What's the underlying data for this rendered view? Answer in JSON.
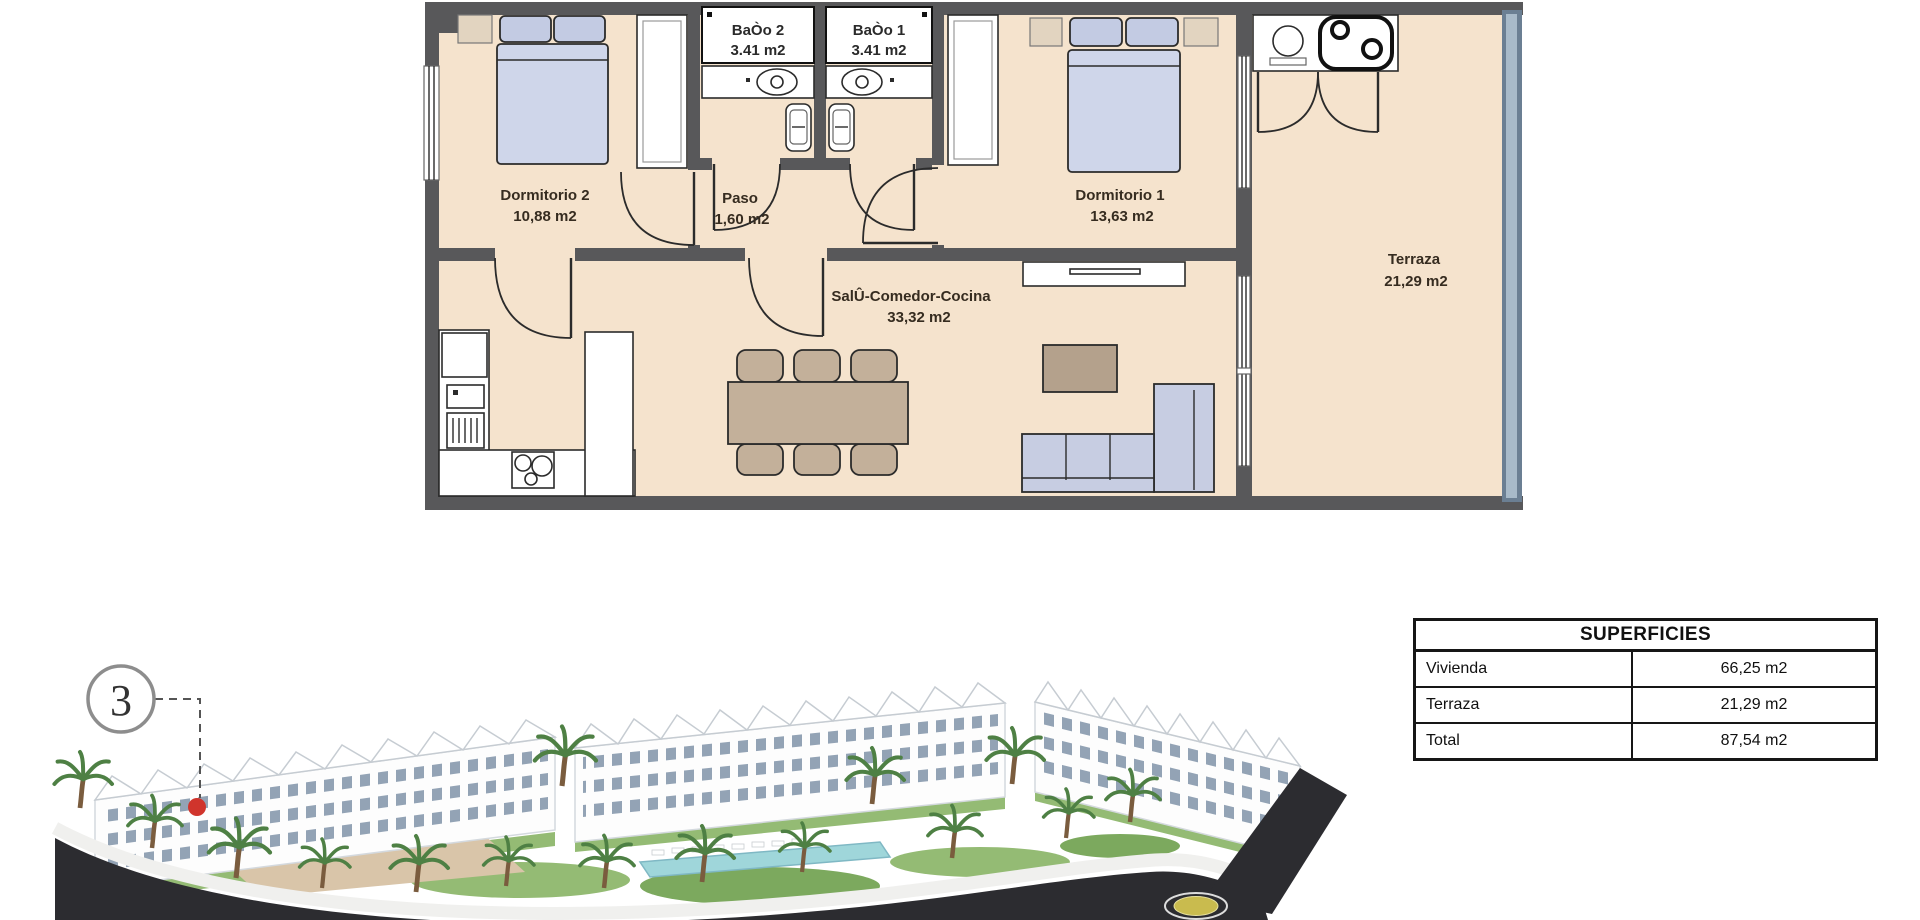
{
  "floor_plan": {
    "rooms": {
      "bano2": {
        "name": "BaÒo 2",
        "area": "3.41 m2"
      },
      "bano1": {
        "name": "BaÒo 1",
        "area": "3.41 m2"
      },
      "dormitorio2": {
        "name": "Dormitorio 2",
        "area": "10,88 m2"
      },
      "paso": {
        "name": "Paso",
        "area": "1,60 m2"
      },
      "dormitorio1": {
        "name": "Dormitorio 1",
        "area": "13,63 m2"
      },
      "salon": {
        "name": "SalÛ-Comedor-Cocina",
        "area": "33,32 m2"
      },
      "terraza": {
        "name": "Terraza",
        "area": "21,29 m2"
      }
    },
    "palette": {
      "wall": "#58585a",
      "floor": "#f5e3cd",
      "bed": "#cfd6ea",
      "sofa": "#c7cde2",
      "wood": "#c3b09a",
      "balustrade": "#8ba0b5"
    }
  },
  "superficies_table": {
    "title": "SUPERFICIES",
    "rows": [
      {
        "label": "Vivienda",
        "value": "66,25 m2"
      },
      {
        "label": "Terraza",
        "value": "21,29 m2"
      },
      {
        "label": "Total",
        "value": "87,54 m2"
      }
    ]
  },
  "site_plan": {
    "unit_badge": "3",
    "marker_color": "#d0342c",
    "road_color": "#2c2c30",
    "pool_color": "#9fd6da",
    "roundabout_center_color": "#c9bb4e"
  }
}
